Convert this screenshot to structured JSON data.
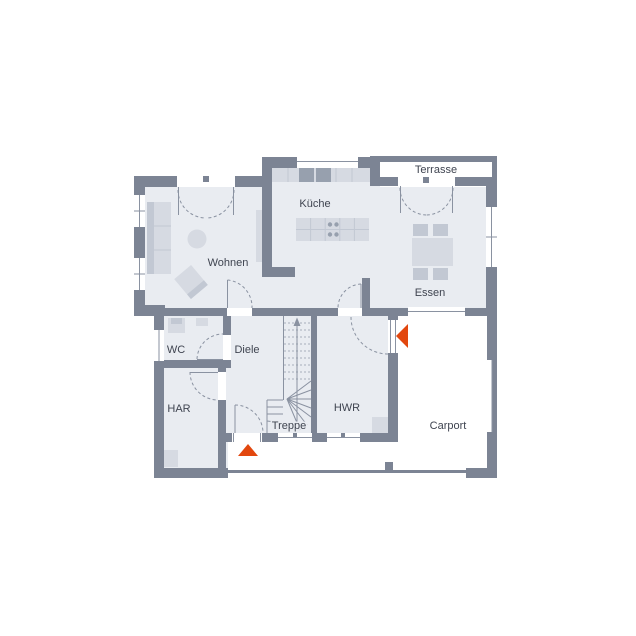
{
  "plan": {
    "rooms": {
      "terrasse": {
        "label": "Terrasse"
      },
      "kueche": {
        "label": "Küche"
      },
      "wohnen": {
        "label": "Wohnen"
      },
      "essen": {
        "label": "Essen"
      },
      "wc": {
        "label": "WC"
      },
      "diele": {
        "label": "Diele"
      },
      "har": {
        "label": "HAR"
      },
      "treppe": {
        "label": "Treppe"
      },
      "hwr": {
        "label": "HWR"
      },
      "carport": {
        "label": "Carport"
      }
    },
    "arrows": [
      {
        "name": "main-entrance-arrow",
        "direction": "up"
      },
      {
        "name": "side-entrance-arrow",
        "direction": "left"
      }
    ]
  },
  "colors": {
    "wall": "#7c8494",
    "floor": "#e9ecf1",
    "furniture": "#d6dae2",
    "furniture_dark": "#c2c8d3",
    "appliance": "#97a0ae",
    "line": "#8a92a1",
    "accent": "#e2470e",
    "text": "#3f4450",
    "white": "#ffffff"
  }
}
